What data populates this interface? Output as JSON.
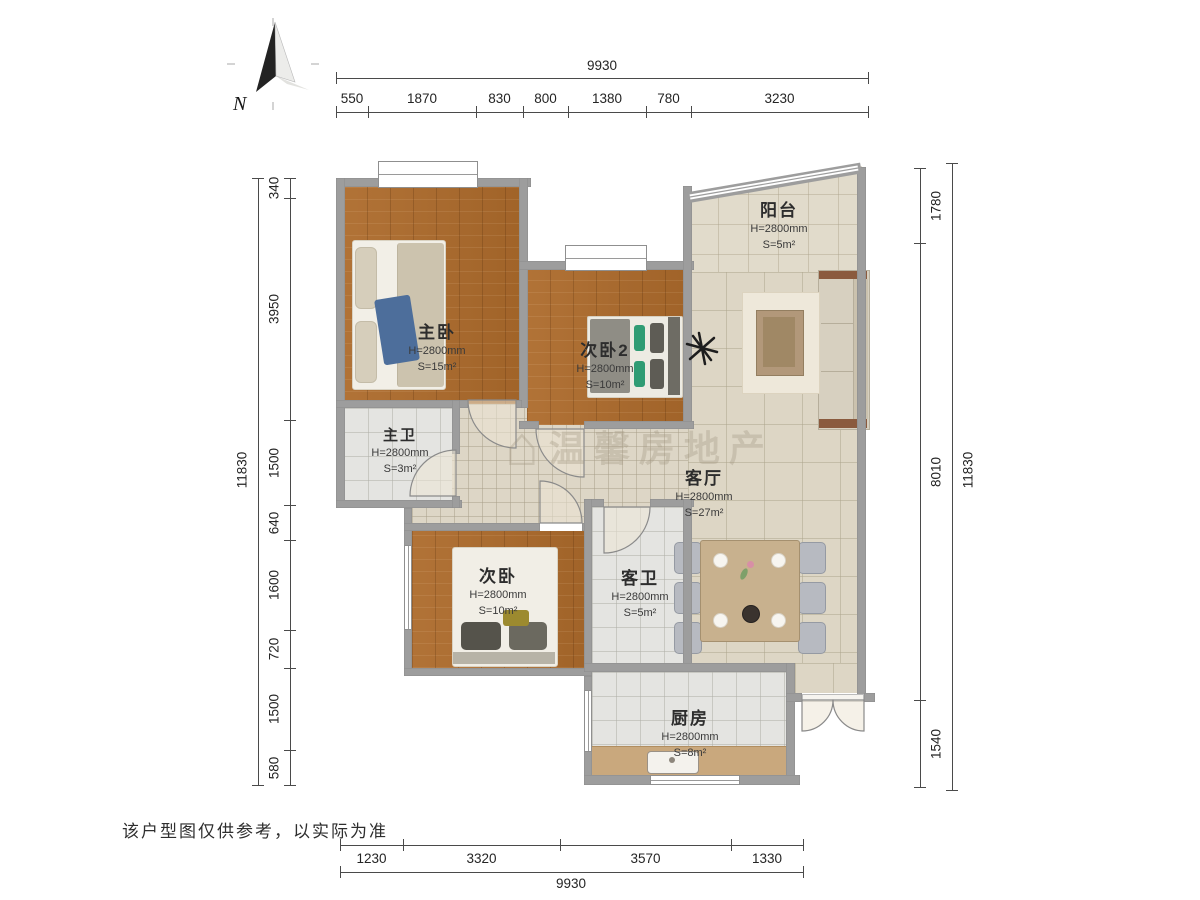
{
  "meta": {
    "compass_label": "N",
    "disclaimer": "该户型图仅供参考，以实际为准",
    "watermark_text": "温馨房地产",
    "wall_color": "#9d9d9d",
    "wood_color": "#ad6b2c",
    "tile_color": "#ddd6c5"
  },
  "rooms": [
    {
      "name": "主卧",
      "height": "H=2800mm",
      "area": "S=15m²"
    },
    {
      "name": "主卫",
      "height": "H=2800mm",
      "area": "S=3m²"
    },
    {
      "name": "次卧2",
      "height": "H=2800mm",
      "area": "S=10m²"
    },
    {
      "name": "阳台",
      "height": "H=2800mm",
      "area": "S=5m²"
    },
    {
      "name": "客厅",
      "height": "H=2800mm",
      "area": "S=27m²"
    },
    {
      "name": "次卧",
      "height": "H=2800mm",
      "area": "S=10m²"
    },
    {
      "name": "客卫",
      "height": "H=2800mm",
      "area": "S=5m²"
    },
    {
      "name": "厨房",
      "height": "H=2800mm",
      "area": "S=8m²"
    }
  ],
  "dimensions": {
    "top": {
      "total": "9930",
      "segments": [
        "550",
        "1870",
        "830",
        "800",
        "1380",
        "780",
        "3230"
      ]
    },
    "bottom": {
      "total": "9930",
      "segments": [
        "1230",
        "3320",
        "3570",
        "1330"
      ]
    },
    "left": {
      "total": "11830",
      "segments": [
        "340",
        "3950",
        "1500",
        "640",
        "1600",
        "720",
        "1500",
        "580"
      ]
    },
    "right": {
      "total": "11830",
      "segments": [
        "1780",
        "8010",
        "1540"
      ]
    }
  }
}
